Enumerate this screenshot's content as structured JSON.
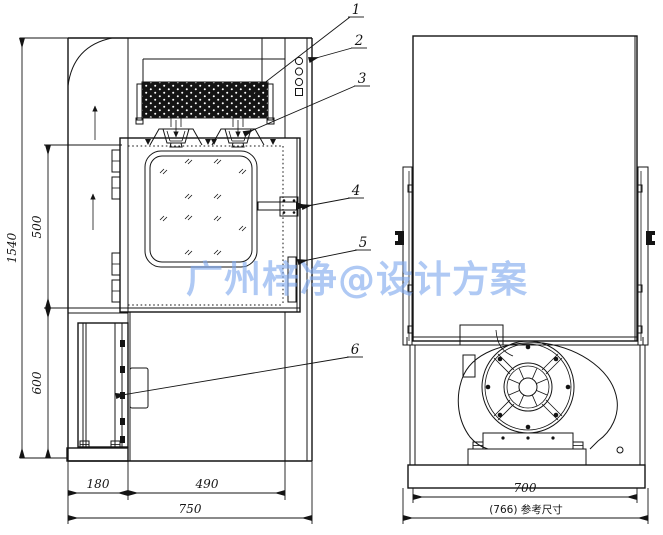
{
  "drawing": {
    "title_watermark": "广州梓净@设计方案",
    "watermark_color": "#7fa9ee",
    "callouts": {
      "c1": "1",
      "c2": "2",
      "c3": "3",
      "c4": "4",
      "c5": "5",
      "c6": "6"
    },
    "front_view": {
      "dim_height_total": "1540",
      "dim_height_upper": "500",
      "dim_height_lower": "600",
      "dim_width_left": "180",
      "dim_width_chamber": "490",
      "dim_width_total": "750"
    },
    "side_view": {
      "dim_depth_body": "700",
      "dim_depth_overall": "(766) 参考尺寸"
    }
  }
}
